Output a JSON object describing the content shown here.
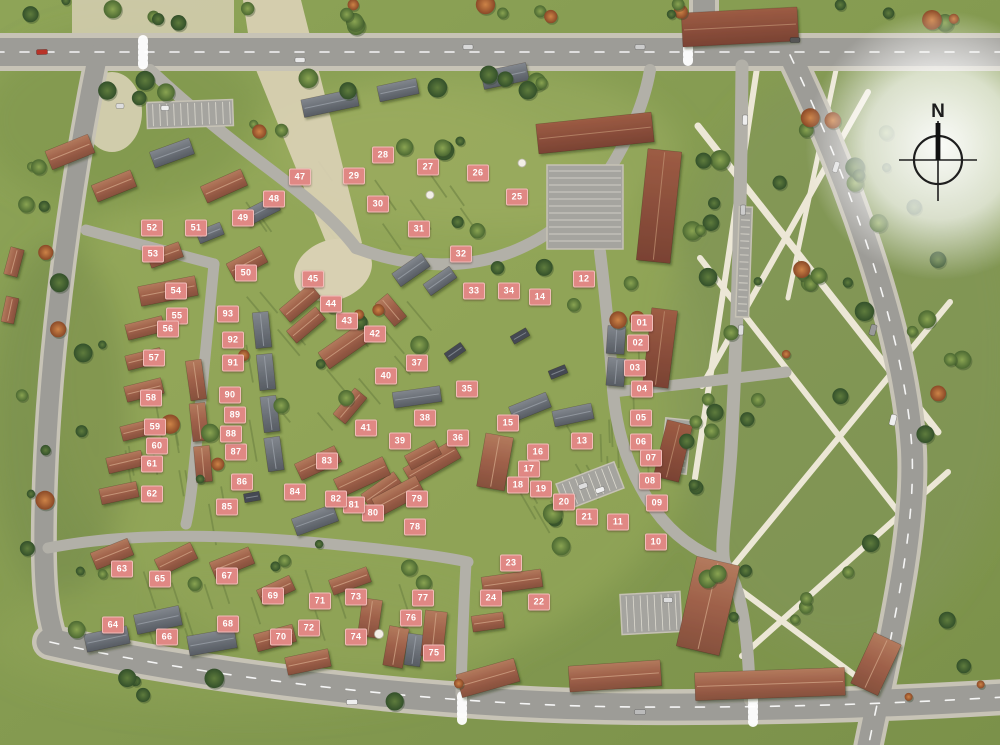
{
  "map": {
    "kind": "residential-development-siteplan"
  },
  "compass": {
    "label": "N"
  },
  "colors": {
    "marker_bg": "#e08884",
    "marker_border": "#f2bdba",
    "marker_text": "#ffffff",
    "compass": "#1e1e1e"
  },
  "markers": [
    {
      "n": "01",
      "x": 642,
      "y": 323
    },
    {
      "n": "02",
      "x": 638,
      "y": 343
    },
    {
      "n": "03",
      "x": 635,
      "y": 368
    },
    {
      "n": "04",
      "x": 642,
      "y": 389
    },
    {
      "n": "05",
      "x": 641,
      "y": 418
    },
    {
      "n": "06",
      "x": 641,
      "y": 442
    },
    {
      "n": "07",
      "x": 651,
      "y": 458
    },
    {
      "n": "08",
      "x": 650,
      "y": 481
    },
    {
      "n": "09",
      "x": 657,
      "y": 503
    },
    {
      "n": "10",
      "x": 656,
      "y": 542
    },
    {
      "n": "11",
      "x": 618,
      "y": 522
    },
    {
      "n": "12",
      "x": 584,
      "y": 279
    },
    {
      "n": "13",
      "x": 582,
      "y": 441
    },
    {
      "n": "14",
      "x": 540,
      "y": 297
    },
    {
      "n": "15",
      "x": 508,
      "y": 423
    },
    {
      "n": "16",
      "x": 538,
      "y": 452
    },
    {
      "n": "17",
      "x": 529,
      "y": 469
    },
    {
      "n": "18",
      "x": 518,
      "y": 485
    },
    {
      "n": "19",
      "x": 541,
      "y": 489
    },
    {
      "n": "20",
      "x": 564,
      "y": 502
    },
    {
      "n": "21",
      "x": 587,
      "y": 517
    },
    {
      "n": "22",
      "x": 539,
      "y": 602
    },
    {
      "n": "23",
      "x": 511,
      "y": 563
    },
    {
      "n": "24",
      "x": 491,
      "y": 598
    },
    {
      "n": "25",
      "x": 517,
      "y": 197
    },
    {
      "n": "26",
      "x": 478,
      "y": 173
    },
    {
      "n": "27",
      "x": 428,
      "y": 167
    },
    {
      "n": "28",
      "x": 383,
      "y": 155
    },
    {
      "n": "29",
      "x": 354,
      "y": 176
    },
    {
      "n": "30",
      "x": 378,
      "y": 204
    },
    {
      "n": "31",
      "x": 419,
      "y": 229
    },
    {
      "n": "32",
      "x": 461,
      "y": 254
    },
    {
      "n": "33",
      "x": 474,
      "y": 291
    },
    {
      "n": "34",
      "x": 509,
      "y": 291
    },
    {
      "n": "35",
      "x": 467,
      "y": 389
    },
    {
      "n": "36",
      "x": 458,
      "y": 438
    },
    {
      "n": "37",
      "x": 417,
      "y": 363
    },
    {
      "n": "38",
      "x": 425,
      "y": 418
    },
    {
      "n": "39",
      "x": 400,
      "y": 441
    },
    {
      "n": "40",
      "x": 386,
      "y": 376
    },
    {
      "n": "41",
      "x": 366,
      "y": 428
    },
    {
      "n": "42",
      "x": 375,
      "y": 334
    },
    {
      "n": "43",
      "x": 347,
      "y": 321
    },
    {
      "n": "44",
      "x": 331,
      "y": 304
    },
    {
      "n": "45",
      "x": 313,
      "y": 279
    },
    {
      "n": "47",
      "x": 300,
      "y": 177
    },
    {
      "n": "48",
      "x": 274,
      "y": 199
    },
    {
      "n": "49",
      "x": 243,
      "y": 218
    },
    {
      "n": "50",
      "x": 246,
      "y": 273
    },
    {
      "n": "51",
      "x": 196,
      "y": 228
    },
    {
      "n": "52",
      "x": 152,
      "y": 228
    },
    {
      "n": "53",
      "x": 153,
      "y": 254
    },
    {
      "n": "54",
      "x": 176,
      "y": 291
    },
    {
      "n": "55",
      "x": 177,
      "y": 316
    },
    {
      "n": "56",
      "x": 168,
      "y": 329
    },
    {
      "n": "57",
      "x": 154,
      "y": 358
    },
    {
      "n": "58",
      "x": 151,
      "y": 398
    },
    {
      "n": "59",
      "x": 155,
      "y": 427
    },
    {
      "n": "60",
      "x": 157,
      "y": 446
    },
    {
      "n": "61",
      "x": 152,
      "y": 464
    },
    {
      "n": "62",
      "x": 152,
      "y": 494
    },
    {
      "n": "63",
      "x": 122,
      "y": 569
    },
    {
      "n": "64",
      "x": 113,
      "y": 625
    },
    {
      "n": "65",
      "x": 160,
      "y": 579
    },
    {
      "n": "66",
      "x": 167,
      "y": 637
    },
    {
      "n": "67",
      "x": 227,
      "y": 576
    },
    {
      "n": "68",
      "x": 228,
      "y": 624
    },
    {
      "n": "69",
      "x": 273,
      "y": 596
    },
    {
      "n": "70",
      "x": 281,
      "y": 637
    },
    {
      "n": "71",
      "x": 320,
      "y": 601
    },
    {
      "n": "72",
      "x": 309,
      "y": 628
    },
    {
      "n": "73",
      "x": 356,
      "y": 597
    },
    {
      "n": "74",
      "x": 356,
      "y": 637
    },
    {
      "n": "75",
      "x": 434,
      "y": 653
    },
    {
      "n": "76",
      "x": 411,
      "y": 618
    },
    {
      "n": "77",
      "x": 423,
      "y": 598
    },
    {
      "n": "78",
      "x": 415,
      "y": 527
    },
    {
      "n": "79",
      "x": 417,
      "y": 499
    },
    {
      "n": "80",
      "x": 373,
      "y": 513
    },
    {
      "n": "81",
      "x": 354,
      "y": 505
    },
    {
      "n": "82",
      "x": 336,
      "y": 499
    },
    {
      "n": "83",
      "x": 327,
      "y": 461
    },
    {
      "n": "84",
      "x": 295,
      "y": 492
    },
    {
      "n": "85",
      "x": 227,
      "y": 507
    },
    {
      "n": "86",
      "x": 242,
      "y": 482
    },
    {
      "n": "87",
      "x": 236,
      "y": 452
    },
    {
      "n": "88",
      "x": 231,
      "y": 434
    },
    {
      "n": "89",
      "x": 235,
      "y": 415
    },
    {
      "n": "90",
      "x": 230,
      "y": 395
    },
    {
      "n": "91",
      "x": 233,
      "y": 363
    },
    {
      "n": "92",
      "x": 233,
      "y": 340
    },
    {
      "n": "93",
      "x": 228,
      "y": 314
    }
  ]
}
